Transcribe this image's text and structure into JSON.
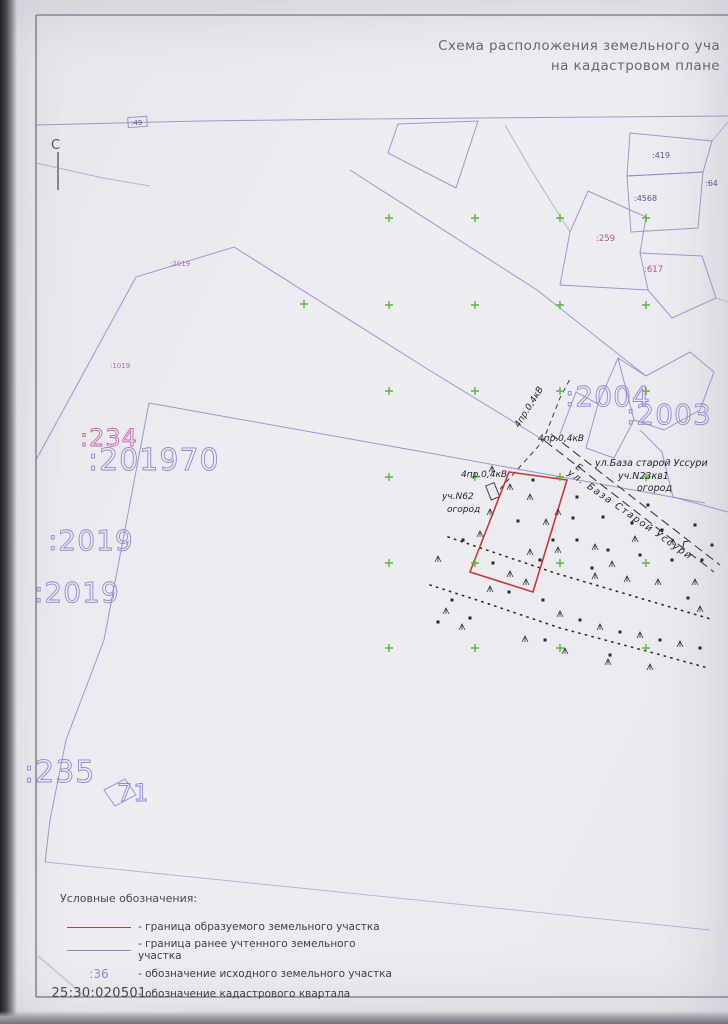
{
  "title": {
    "line1": "Схема расположения земельного уча",
    "line2": "на кадастровом плане"
  },
  "north": {
    "label": "С"
  },
  "parcels": {
    "p49": ":49",
    "p419": ":419",
    "p64": ":64",
    "p4568": ":4568",
    "p259": ":259",
    "p617": ":617",
    "p2004": ":2004",
    "p2003": ":2003",
    "p234": ":234",
    "p201970": ":201970",
    "p2019a": ":2019",
    "p2019b": ":2019",
    "p235": ":235",
    "p71": "71",
    "p2019_small": ":2019",
    "p1019_small": ":1019"
  },
  "annotations": {
    "power1": "4пр.0,4кВ",
    "power2": "4пр.0,4кВ",
    "power3": "4пр.0,4кВ",
    "street_block_line1": "ул.База старой Уссури",
    "street_block_line2": "уч.N23кв1",
    "street_block_line3": "огород",
    "road_name": "ул. База Старой Уссури",
    "plot62_line1": "уч.N62",
    "plot62_line2": "огород",
    "point_e": "Е",
    "point_g": "Г"
  },
  "legend": {
    "header": "Условные обозначения:",
    "items": [
      {
        "swatch": "red-line",
        "label": "- граница образуемого земельного участка"
      },
      {
        "swatch": "purple-line",
        "label": "- граница ранее учтенного земельного участка"
      },
      {
        "swatch_text": ":36",
        "label": "- обозначение исходного земельного участка"
      },
      {
        "swatch_text": "25:30:020501",
        "label": "- обозначение кадастрового квартала"
      }
    ]
  },
  "colors": {
    "boundary_new": "#c23b3b",
    "boundary_old": "#8d89c9",
    "parcel_number_blue": "#8d8bd0",
    "parcel_number_magenta": "#c468aa",
    "grid_cross_green": "#5cb341"
  },
  "map_marks": {
    "cross_grid": {
      "cols": [
        389,
        475,
        560,
        646
      ],
      "rows": [
        218,
        305,
        391,
        477,
        563,
        648
      ],
      "extra": [
        [
          304,
          304
        ]
      ]
    },
    "dots": [
      [
        533,
        480
      ],
      [
        573,
        518
      ],
      [
        518,
        521
      ],
      [
        553,
        540
      ],
      [
        493,
        563
      ],
      [
        540,
        560
      ],
      [
        463,
        540
      ],
      [
        509,
        592
      ],
      [
        543,
        600
      ],
      [
        577,
        497
      ],
      [
        603,
        517
      ],
      [
        632,
        523
      ],
      [
        662,
        530
      ],
      [
        695,
        525
      ],
      [
        577,
        540
      ],
      [
        608,
        550
      ],
      [
        640,
        555
      ],
      [
        672,
        560
      ],
      [
        702,
        560
      ],
      [
        592,
        568
      ],
      [
        452,
        600
      ],
      [
        438,
        622
      ],
      [
        580,
        620
      ],
      [
        620,
        632
      ],
      [
        660,
        640
      ],
      [
        700,
        648
      ],
      [
        545,
        640
      ],
      [
        610,
        655
      ],
      [
        470,
        618
      ],
      [
        688,
        598
      ],
      [
        712,
        545
      ],
      [
        648,
        505
      ]
    ],
    "grass": [
      [
        492,
        470
      ],
      [
        530,
        498
      ],
      [
        510,
        488
      ],
      [
        490,
        513
      ],
      [
        558,
        513
      ],
      [
        480,
        535
      ],
      [
        530,
        553
      ],
      [
        558,
        551
      ],
      [
        510,
        575
      ],
      [
        526,
        583
      ],
      [
        490,
        590
      ],
      [
        546,
        523
      ],
      [
        595,
        548
      ],
      [
        635,
        540
      ],
      [
        673,
        543
      ],
      [
        595,
        577
      ],
      [
        627,
        580
      ],
      [
        658,
        583
      ],
      [
        695,
        583
      ],
      [
        612,
        565
      ],
      [
        446,
        612
      ],
      [
        462,
        628
      ],
      [
        560,
        615
      ],
      [
        600,
        628
      ],
      [
        640,
        636
      ],
      [
        680,
        645
      ],
      [
        525,
        640
      ],
      [
        565,
        652
      ],
      [
        608,
        663
      ],
      [
        650,
        668
      ],
      [
        700,
        610
      ],
      [
        438,
        560
      ]
    ]
  }
}
